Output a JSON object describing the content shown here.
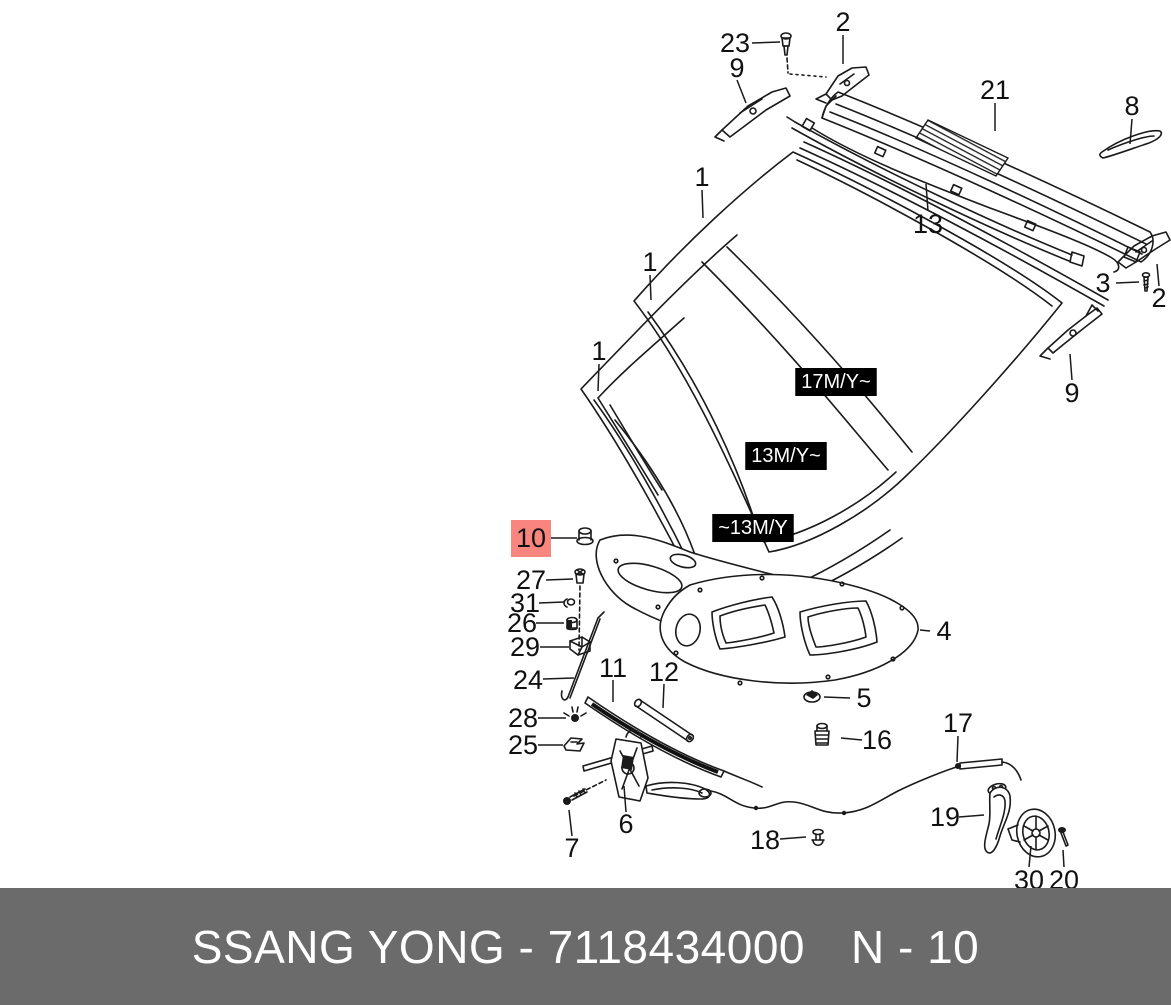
{
  "footer": {
    "left_text": "SSANG YONG - 7118434000",
    "right_text": "N - 10",
    "bg_color": "#6b6b6b",
    "text_color": "#ffffff"
  },
  "highlight": {
    "part": "10",
    "fill": "#f9867e",
    "text_color": "#8b1a14"
  },
  "line_color": "#1a1a1a",
  "model_year_tags": [
    {
      "label": "17M/Y~",
      "x": 836,
      "y": 381
    },
    {
      "label": "13M/Y~",
      "x": 786,
      "y": 455
    },
    {
      "label": "~13M/Y",
      "x": 753,
      "y": 527
    }
  ],
  "callouts": [
    {
      "label": "23",
      "x": 735,
      "y": 43,
      "leader": [
        [
          752,
          43
        ],
        [
          780,
          42
        ]
      ],
      "highlighted": false
    },
    {
      "label": "9",
      "x": 737,
      "y": 68,
      "leader": [
        [
          737,
          80
        ],
        [
          746,
          103
        ]
      ],
      "highlighted": false
    },
    {
      "label": "2",
      "x": 843,
      "y": 22,
      "leader": [
        [
          843,
          35
        ],
        [
          843,
          64
        ]
      ],
      "highlighted": false
    },
    {
      "label": "21",
      "x": 995,
      "y": 90,
      "leader": [
        [
          995,
          103
        ],
        [
          995,
          131
        ]
      ],
      "highlighted": false
    },
    {
      "label": "8",
      "x": 1132,
      "y": 106,
      "leader": [
        [
          1132,
          119
        ],
        [
          1130,
          144
        ]
      ],
      "highlighted": false
    },
    {
      "label": "13",
      "x": 928,
      "y": 224,
      "leader": [
        [
          928,
          211
        ],
        [
          926,
          184
        ]
      ],
      "highlighted": false
    },
    {
      "label": "3",
      "x": 1103,
      "y": 283,
      "leader": [
        [
          1116,
          283
        ],
        [
          1139,
          282
        ]
      ],
      "highlighted": false
    },
    {
      "label": "2",
      "x": 1159,
      "y": 298,
      "leader": [
        [
          1159,
          286
        ],
        [
          1157,
          264
        ]
      ],
      "highlighted": false
    },
    {
      "label": "1",
      "x": 702,
      "y": 177,
      "leader": [
        [
          702,
          190
        ],
        [
          703,
          218
        ]
      ],
      "highlighted": false
    },
    {
      "label": "1",
      "x": 650,
      "y": 262,
      "leader": [
        [
          650,
          275
        ],
        [
          651,
          300
        ]
      ],
      "highlighted": false
    },
    {
      "label": "1",
      "x": 599,
      "y": 351,
      "leader": [
        [
          599,
          364
        ],
        [
          598,
          391
        ]
      ],
      "highlighted": false
    },
    {
      "label": "9",
      "x": 1072,
      "y": 393,
      "leader": [
        [
          1072,
          380
        ],
        [
          1070,
          354
        ]
      ],
      "highlighted": false
    },
    {
      "label": "10",
      "x": 531,
      "y": 538,
      "leader": [
        [
          551,
          538
        ],
        [
          577,
          538
        ]
      ],
      "highlighted": true
    },
    {
      "label": "27",
      "x": 531,
      "y": 580,
      "leader": [
        [
          546,
          580
        ],
        [
          573,
          579
        ]
      ],
      "highlighted": false
    },
    {
      "label": "31",
      "x": 525,
      "y": 603,
      "leader": [
        [
          539,
          603
        ],
        [
          564,
          602
        ]
      ],
      "highlighted": false
    },
    {
      "label": "26",
      "x": 522,
      "y": 623,
      "leader": [
        [
          536,
          623
        ],
        [
          564,
          623
        ]
      ],
      "highlighted": false
    },
    {
      "label": "29",
      "x": 525,
      "y": 647,
      "leader": [
        [
          540,
          647
        ],
        [
          569,
          647
        ]
      ],
      "highlighted": false
    },
    {
      "label": "24",
      "x": 528,
      "y": 680,
      "leader": [
        [
          543,
          679
        ],
        [
          574,
          678
        ]
      ],
      "highlighted": false
    },
    {
      "label": "28",
      "x": 523,
      "y": 718,
      "leader": [
        [
          538,
          718
        ],
        [
          566,
          718
        ]
      ],
      "highlighted": false
    },
    {
      "label": "25",
      "x": 523,
      "y": 745,
      "leader": [
        [
          538,
          745
        ],
        [
          563,
          745
        ]
      ],
      "highlighted": false
    },
    {
      "label": "11",
      "x": 613,
      "y": 668,
      "leader": [
        [
          613,
          680
        ],
        [
          613,
          702
        ]
      ],
      "highlighted": false
    },
    {
      "label": "12",
      "x": 664,
      "y": 672,
      "leader": [
        [
          664,
          684
        ],
        [
          663,
          708
        ]
      ],
      "highlighted": false
    },
    {
      "label": "4",
      "x": 944,
      "y": 631,
      "leader": [
        [
          930,
          631
        ],
        [
          920,
          630
        ]
      ],
      "highlighted": false
    },
    {
      "label": "5",
      "x": 864,
      "y": 698,
      "leader": [
        [
          850,
          698
        ],
        [
          824,
          697
        ]
      ],
      "highlighted": false
    },
    {
      "label": "16",
      "x": 877,
      "y": 740,
      "leader": [
        [
          862,
          740
        ],
        [
          841,
          738
        ]
      ],
      "highlighted": false
    },
    {
      "label": "17",
      "x": 958,
      "y": 723,
      "leader": [
        [
          958,
          736
        ],
        [
          957,
          762
        ]
      ],
      "highlighted": false
    },
    {
      "label": "6",
      "x": 626,
      "y": 824,
      "leader": [
        [
          626,
          812
        ],
        [
          624,
          786
        ]
      ],
      "highlighted": false
    },
    {
      "label": "7",
      "x": 572,
      "y": 848,
      "leader": [
        [
          572,
          836
        ],
        [
          569,
          810
        ]
      ],
      "highlighted": false
    },
    {
      "label": "18",
      "x": 765,
      "y": 840,
      "leader": [
        [
          780,
          839
        ],
        [
          806,
          837
        ]
      ],
      "highlighted": false
    },
    {
      "label": "19",
      "x": 945,
      "y": 817,
      "leader": [
        [
          959,
          817
        ],
        [
          984,
          815
        ]
      ],
      "highlighted": false
    },
    {
      "label": "30",
      "x": 1029,
      "y": 880,
      "leader": [
        [
          1029,
          867
        ],
        [
          1031,
          846
        ]
      ],
      "highlighted": false
    },
    {
      "label": "20",
      "x": 1064,
      "y": 880,
      "leader": [
        [
          1064,
          867
        ],
        [
          1063,
          850
        ]
      ],
      "highlighted": false
    }
  ]
}
